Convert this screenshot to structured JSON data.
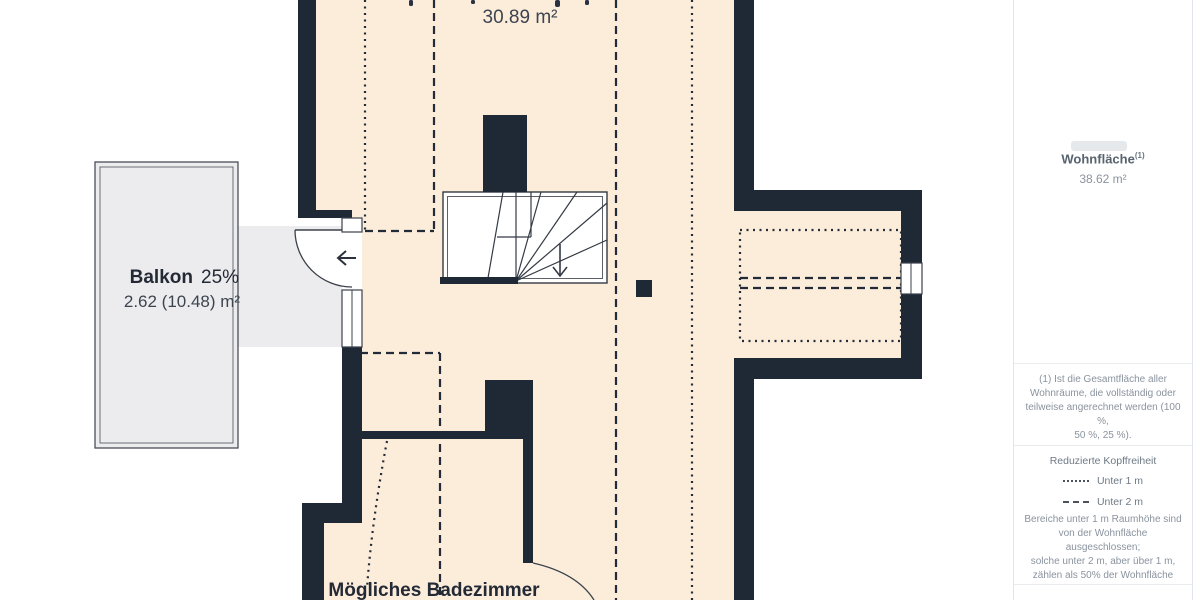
{
  "floor_plan": {
    "main_room": {
      "area_label": "30.89 m²"
    },
    "balcony": {
      "name": "Balkon",
      "percent": "25%",
      "area": "2.62 (10.48) m²"
    },
    "bathroom": {
      "label": "Mögliches Badezimmer"
    },
    "colors": {
      "wall": "#1f2936",
      "room_fill": "#fcecda",
      "balcony_fill": "#ececee",
      "line": "#232b38"
    }
  },
  "sidebar": {
    "living_area": {
      "label": "Wohnfläche",
      "sup": "(1)",
      "value": "38.62 m²"
    },
    "footnote": "(1) Ist die Gesamtfläche aller\nWohnräume, die vollständig oder\nteilweise angerechnet werden (100 %,\n50 %, 25 %).",
    "legend": {
      "title": "Reduzierte Kopffreiheit",
      "items": [
        {
          "style": "dotted",
          "label": "Unter 1 m"
        },
        {
          "style": "dashed",
          "label": "Unter 2 m"
        }
      ],
      "note": "Bereiche unter 1 m Raumhöhe sind\nvon der Wohnfläche ausgeschlossen;\nsolche unter 2 m, aber über 1 m,\nzählen als 50% der Wohnfläche"
    }
  }
}
